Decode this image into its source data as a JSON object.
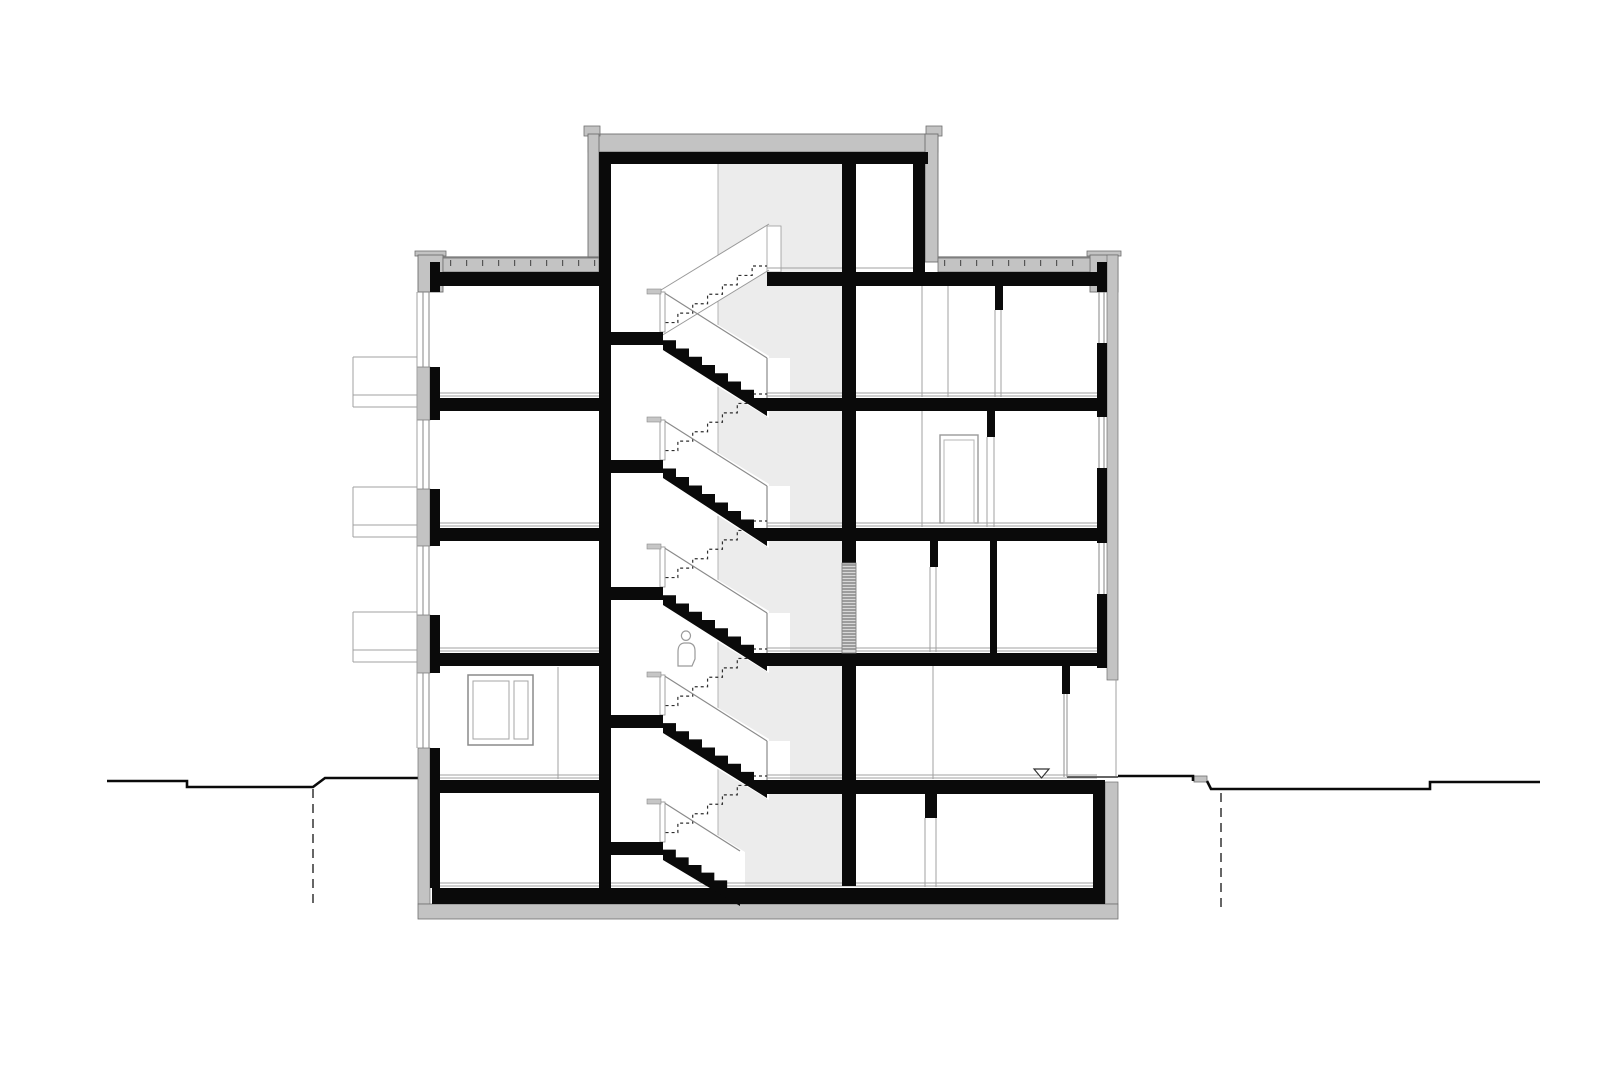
{
  "title": "Residential building cross-section drawing",
  "drawing": {
    "type": "architectural section",
    "floors_above_ground": 4,
    "has_basement": true,
    "has_stair_tower": true,
    "stair_half_landings": 5,
    "cut_stair_flights": 5,
    "hidden_stair_flights_dashed": 5,
    "balconies_left": 3,
    "facade_windows_right": 3,
    "level_marker": "inverted-triangle",
    "human_figure": true,
    "excavation_lines": "dashed"
  },
  "colors": {
    "background": "#ffffff",
    "ink": "#0a0a0a",
    "poche_gray": "#c3c3c3",
    "poche_outline": "#6f6f6f",
    "shaft_gray": "#ececec",
    "grille_bg": "#d8d8d8",
    "grille_line": "#5f5f5f",
    "thin_line": "#a0a0a0",
    "rail_line": "#8a8a8a",
    "dash_line": "#2e2e2e",
    "tick_color": "#555555",
    "terrain": "#0a0a0a",
    "figure_line": "#9a9a9a"
  }
}
